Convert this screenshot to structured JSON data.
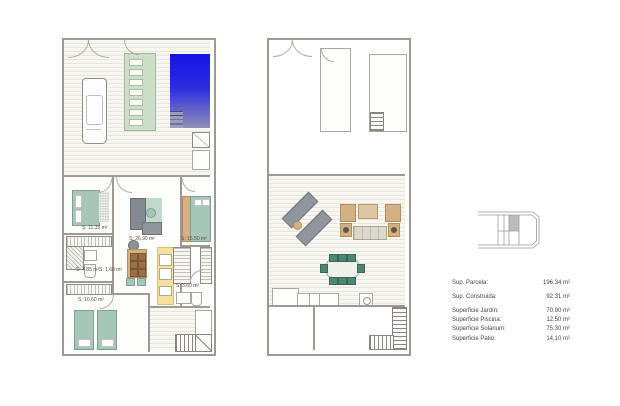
{
  "ground_floor": {
    "labels": {
      "bedroom_top_left": "S: 11.35 m²",
      "living_room": "S: 26.90 m²",
      "bedroom_top_right": "S: 15.50 m²",
      "bathroom_left": "S: 4.85 m²",
      "hall": "S: 1.60 m²",
      "bedroom_bottom_left": "S: 10.60 m²",
      "bathroom_right": "S: 3.60 m²"
    }
  },
  "legend": {
    "rows": [
      {
        "label": "Sup. Parcela:",
        "value": "196.34 m²"
      },
      {
        "label": "Sup. Construida:",
        "value": "92.31 m²"
      },
      {
        "label": "Superficie Jardín:",
        "value": "70.90 m²"
      },
      {
        "label": "Superficie Piscina:",
        "value": "12.50 m²"
      },
      {
        "label": "Superficie Solarium:",
        "value": "75.30 m²"
      },
      {
        "label": "Superficie Patio:",
        "value": "14.10 m²"
      }
    ]
  },
  "colors": {
    "wall": "#9e9992",
    "pool-top": "#1813e6",
    "pool-bottom": "#9191b8",
    "garden": "#ccdfc8",
    "teal": "#a6c7b8",
    "wood": "#d3b184",
    "kitchen": "#f6e0a0",
    "gray-furniture": "#90969b"
  }
}
